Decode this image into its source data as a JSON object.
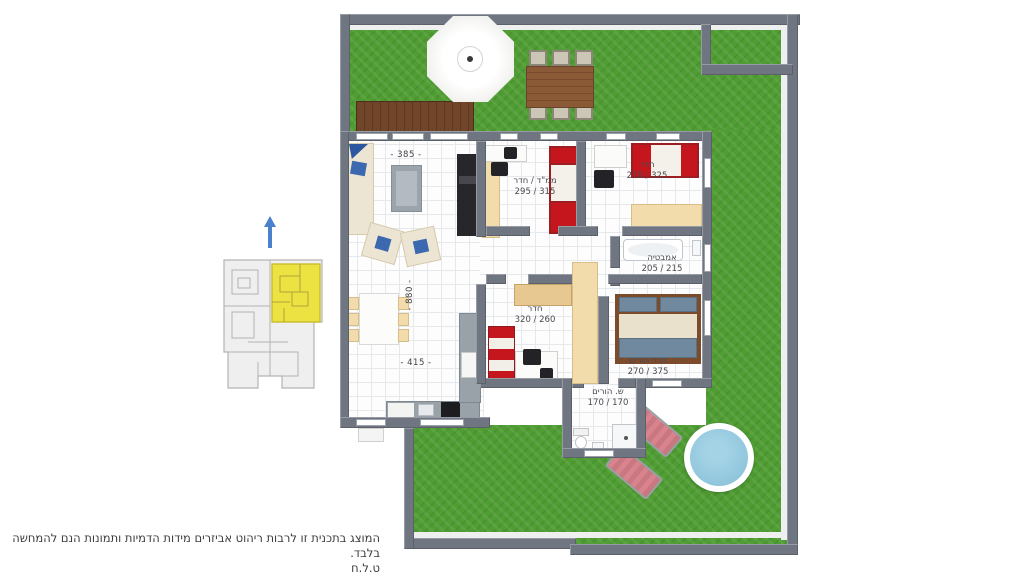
{
  "plan": {
    "rooms": [
      {
        "name": "ממ\"ד / חדר",
        "dims": "315 / 295"
      },
      {
        "name": "חדר",
        "dims": "325 / 270"
      },
      {
        "name": "אמבטיה",
        "dims": "215 / 205"
      },
      {
        "name": "חדר",
        "dims": "260 / 320"
      },
      {
        "name": "חדר הורים",
        "dims": "375 / 270"
      },
      {
        "name": "ש. הורים",
        "dims": "170 / 170"
      }
    ],
    "living_dimensions": {
      "top": "- 385 -",
      "middle": "- 880 -",
      "bottom": "- 415 -"
    }
  },
  "minimap": {
    "highlight_color": "#ece242",
    "building_color": "#efefef",
    "outline_color": "#b3b3b3",
    "north_arrow_icon": "north-arrow",
    "north_arrow_color": "#4a80cc"
  },
  "disclaimer": {
    "line1": "המוצג בתכנית זו לרבות ריהוט אביזרים מידות הדמיות ותמונות הנם להמחשה בלבד.",
    "line2": "ט.ל.ח"
  },
  "palette": {
    "grass": "#4f9d33",
    "wall": "#6f7681",
    "floor": "#fdfdfd",
    "bed_red": "#c5161d",
    "wardrobe_cream": "#f2dcab",
    "pool_water": "#90c6dc",
    "lounger_pink": "#d8838e",
    "deck_brown": "#71452a"
  }
}
